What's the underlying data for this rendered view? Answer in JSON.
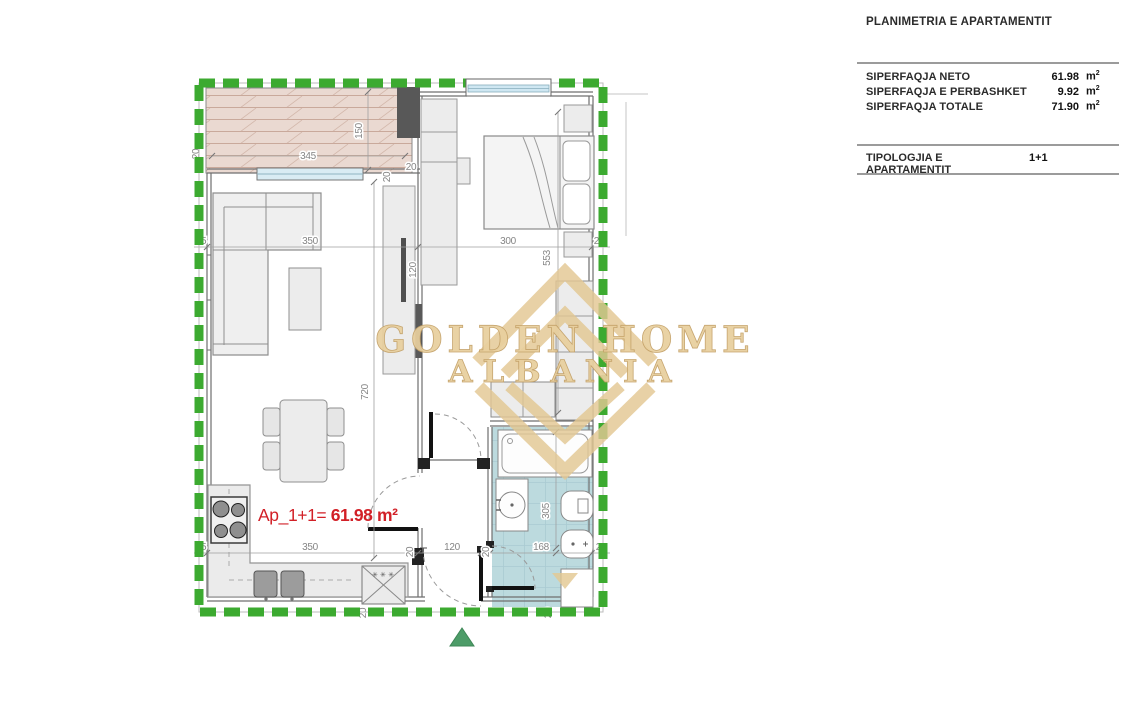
{
  "panel": {
    "title": "PLANIMETRIA E APARTAMENTIT",
    "rows": [
      {
        "label": "SIPERFAQJA NETO",
        "value": "61.98",
        "unit": "m",
        "sup": "2"
      },
      {
        "label": "SIPERFAQJA E PERBASHKET",
        "value": "9.92",
        "unit": "m",
        "sup": "2"
      },
      {
        "label": "SIPERFAQJA TOTALE",
        "value": "71.90",
        "unit": "m",
        "sup": "2"
      }
    ],
    "typology": {
      "label": "TIPOLOGJIA E APARTAMENTIT",
      "value": "1+1"
    }
  },
  "plan": {
    "area_label": {
      "prefix": "Ap_1+1=",
      "value": "61.98 m²"
    },
    "watermark": {
      "line1": "GOLDEN HOME",
      "line2": "ALBANIA"
    },
    "appliance_marks": "✳ ✳ ✳",
    "dims": {
      "d20": "20",
      "d25": "25",
      "d120": "120",
      "d150": "150",
      "d168": "168",
      "d300": "300",
      "d305": "305",
      "d345": "345",
      "d350": "350",
      "d553": "553",
      "d720": "720"
    },
    "colors": {
      "border_green": "#3caa30",
      "marker_green": "#4d9c68",
      "accent_red": "#d22027",
      "watermark_gold": "#e8cf9e",
      "bath_blue": "#bcdade",
      "wood": "#ead9d1",
      "dark_wall": "#595959",
      "furniture": "#ececec"
    }
  }
}
